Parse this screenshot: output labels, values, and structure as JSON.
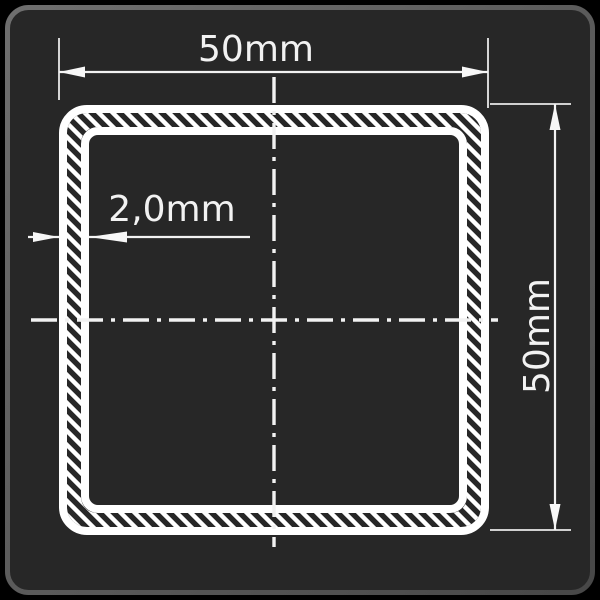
{
  "dimensions": {
    "width": {
      "label": "50mm"
    },
    "height": {
      "label": "50mm"
    },
    "wall_thickness": {
      "label": "2,0mm"
    }
  },
  "colors": {
    "canvas_background": "#000000",
    "tile_fill": "#272727",
    "tile_border_light": "#6f6f6f",
    "tile_border_dark": "#474747",
    "drawing_line": "#ffffff",
    "label_text": "#f2f2f2"
  }
}
